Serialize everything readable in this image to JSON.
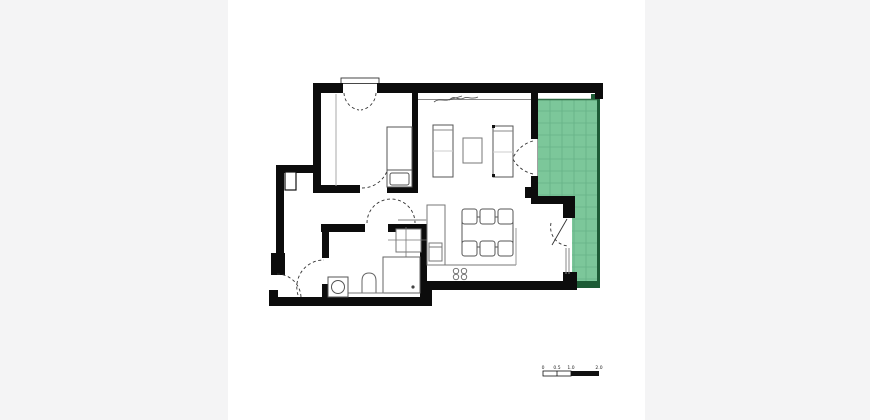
{
  "page": {
    "background": "#f4f4f5",
    "sheet_background": "#ffffff",
    "description": "apartment floor plan with green terrace"
  },
  "colors": {
    "wall": "#0c0c0c",
    "terrace_fill": "#7cc79a",
    "terrace_grid": "#66b287",
    "terrace_edge": "#1d5c36",
    "furniture_stroke": "#555555",
    "light_stroke": "#999999",
    "door_arc": "#333333",
    "window_line": "#888888",
    "scale_black": "#111111"
  },
  "scale_bar": {
    "labels": [
      "0",
      "0.5",
      "1.0",
      "2.0"
    ]
  },
  "plan_elements": {
    "rooms": [
      "bedroom",
      "hallway",
      "bathroom",
      "living-room",
      "dining-kitchen",
      "terrace"
    ],
    "furniture": [
      "bed",
      "closet-line",
      "sofa-left",
      "sofa-right",
      "coffee-table",
      "dining-table",
      "dining-chairs",
      "kitchen-cabinet",
      "kitchen-appliance",
      "stove-burners",
      "washbasin",
      "shower",
      "toilet",
      "washing-machine",
      "duct-shaft"
    ],
    "doors": [
      "entrance-door",
      "bathroom-door",
      "bedroom-door",
      "corridor-door",
      "terrace-french-doors",
      "terrace-dining-door",
      "bedroom-window-casements"
    ]
  }
}
